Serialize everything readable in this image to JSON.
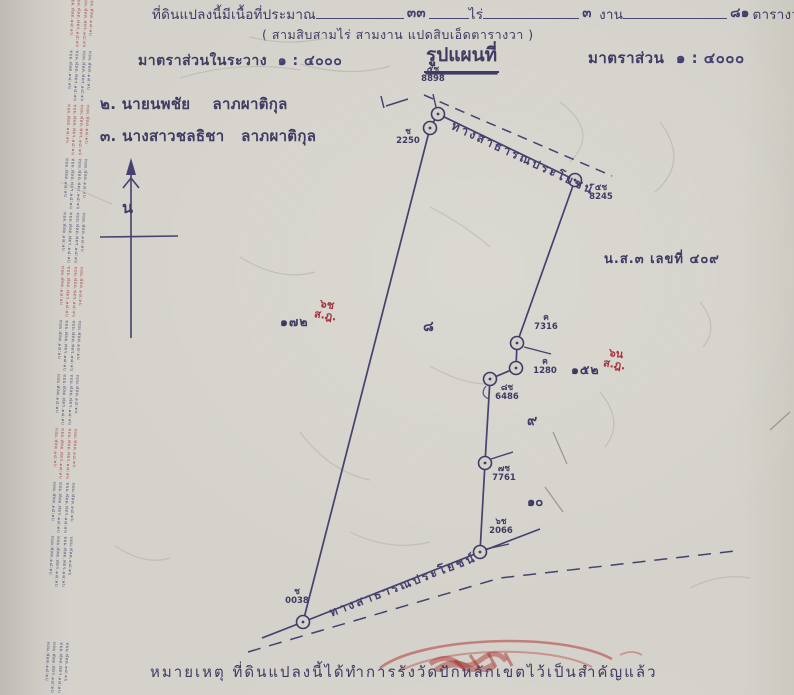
{
  "header": {
    "area_label": "ที่ดินแปลงนี้มีเนื้อที่ประมาณ",
    "rai_value": "๓๓",
    "rai_unit": "ไร่",
    "ngan_value": "๓",
    "ngan_unit": "งาน",
    "wa_value": "๘๑",
    "wa_unit": "ตารางวา",
    "area_words": "( สามสิบสามไร่ สามงาน แปดสิบเอ็ดตารางวา )",
    "scale_left_label": "มาตราส่วนในระวาง",
    "scale_left_value": "๑ : ๔๐๐๐",
    "map_title": "รูปแผนที่",
    "scale_right_label": "มาตราส่วน",
    "scale_right_value": "๑ : ๔๐๐๐"
  },
  "owners": [
    {
      "text": "๒. นายนพชัย    ลาภผาติกุล"
    },
    {
      "text": "๓. นางสาวชลธิชา   ลาภผาติกุล"
    }
  ],
  "compass": {
    "north_label": "น"
  },
  "map": {
    "road_top_label": "ทางสาธารณประโยชน์",
    "road_bottom_label": "ทางสาธารณประโยชน์",
    "ns3_note": "น.ส.๓ เลขที่ ๔๐๙",
    "markers": [
      {
        "code": "๕ช",
        "number": "8898"
      },
      {
        "code": "ช",
        "number": "2250"
      },
      {
        "code": "๕ช",
        "number": "8245"
      },
      {
        "code": "ค",
        "number": "7316"
      },
      {
        "code": "ค",
        "number": "1280"
      },
      {
        "code": "๘ช",
        "number": "6486"
      },
      {
        "code": "๗ช",
        "number": "7761"
      },
      {
        "code": "๖ช",
        "number": "2066"
      },
      {
        "code": "ช",
        "number": "0038"
      }
    ],
    "interior_marks": [
      {
        "text": "๘"
      },
      {
        "text": "๙"
      },
      {
        "text": "๑๐"
      }
    ],
    "adjacent_notes": [
      {
        "number": "๑๗๒",
        "red_line1": "๖ช",
        "red_line2": "ส.ฎ."
      },
      {
        "number": "๑๕๒",
        "red_line1": "๖น",
        "red_line2": "ส.ฎ."
      }
    ]
  },
  "margin": {
    "stamp_lines": [
      "ทยผ.ฬลต.๑๘:๑บ",
      "ทยผ.ฬลต.ฟตร.๑๘:๑บ",
      "ทยผ.ฬลต.ฟตร.๑๘:๑บ",
      "ทยผ.ฬลต.๑๘:๑บ"
    ],
    "blocks": [
      {
        "color": "#a43b48"
      },
      {
        "color": "#474272"
      },
      {
        "color": "#a43b48"
      },
      {
        "color": "#474272"
      },
      {
        "color": "#474272"
      },
      {
        "color": "#a43b48"
      },
      {
        "color": "#474272"
      },
      {
        "color": "#474272"
      },
      {
        "color": "#a43b48"
      },
      {
        "color": "#474272"
      },
      {
        "color": "#474272"
      },
      {
        "color": "#474272"
      }
    ]
  },
  "bottom_edge": {
    "partial_text": "หมายเหตุ ที่ดินแปลงนี้ได้ทำการรังวัดปักหลักเขตไว้เป็นสำคัญแล้ว",
    "truncated": true
  },
  "colors": {
    "ink": "#3f3b63",
    "handwriting_red": "#a4333f",
    "stamp_red": "#b03a3a",
    "paper": "#d3d1c9"
  }
}
